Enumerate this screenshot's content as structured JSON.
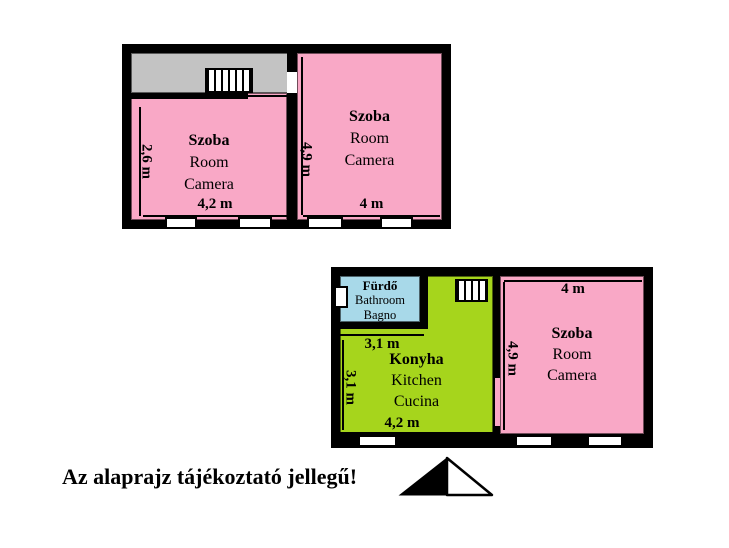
{
  "colors": {
    "wall": "#000000",
    "room": "#f9a8c6",
    "kitchen": "#a6d51c",
    "bathroom": "#a8d9e9",
    "corridor": "#c3c3c3",
    "window": "#ffffff"
  },
  "notice": "Az alaprajz tájékoztató jellegű!",
  "upper_unit": {
    "room_left": {
      "hu": "Szoba",
      "en": "Room",
      "it": "Camera",
      "width": "4,2 m",
      "depth": "2,6 m"
    },
    "room_right": {
      "hu": "Szoba",
      "en": "Room",
      "it": "Camera",
      "width": "4 m",
      "depth": "4,9 m"
    }
  },
  "lower_unit": {
    "bathroom": {
      "hu": "Fürdő",
      "en": "Bathroom",
      "it": "Bagno"
    },
    "kitchen": {
      "hu": "Konyha",
      "en": "Kitchen",
      "it": "Cucina",
      "width": "4,2 m",
      "top_width": "3,1 m",
      "depth": "3,1 m"
    },
    "room": {
      "hu": "Szoba",
      "en": "Room",
      "it": "Camera",
      "width": "4 m",
      "depth": "4,9 m"
    }
  },
  "icons": {
    "stairs": "stairs-hatch",
    "north": "north-arrow"
  }
}
